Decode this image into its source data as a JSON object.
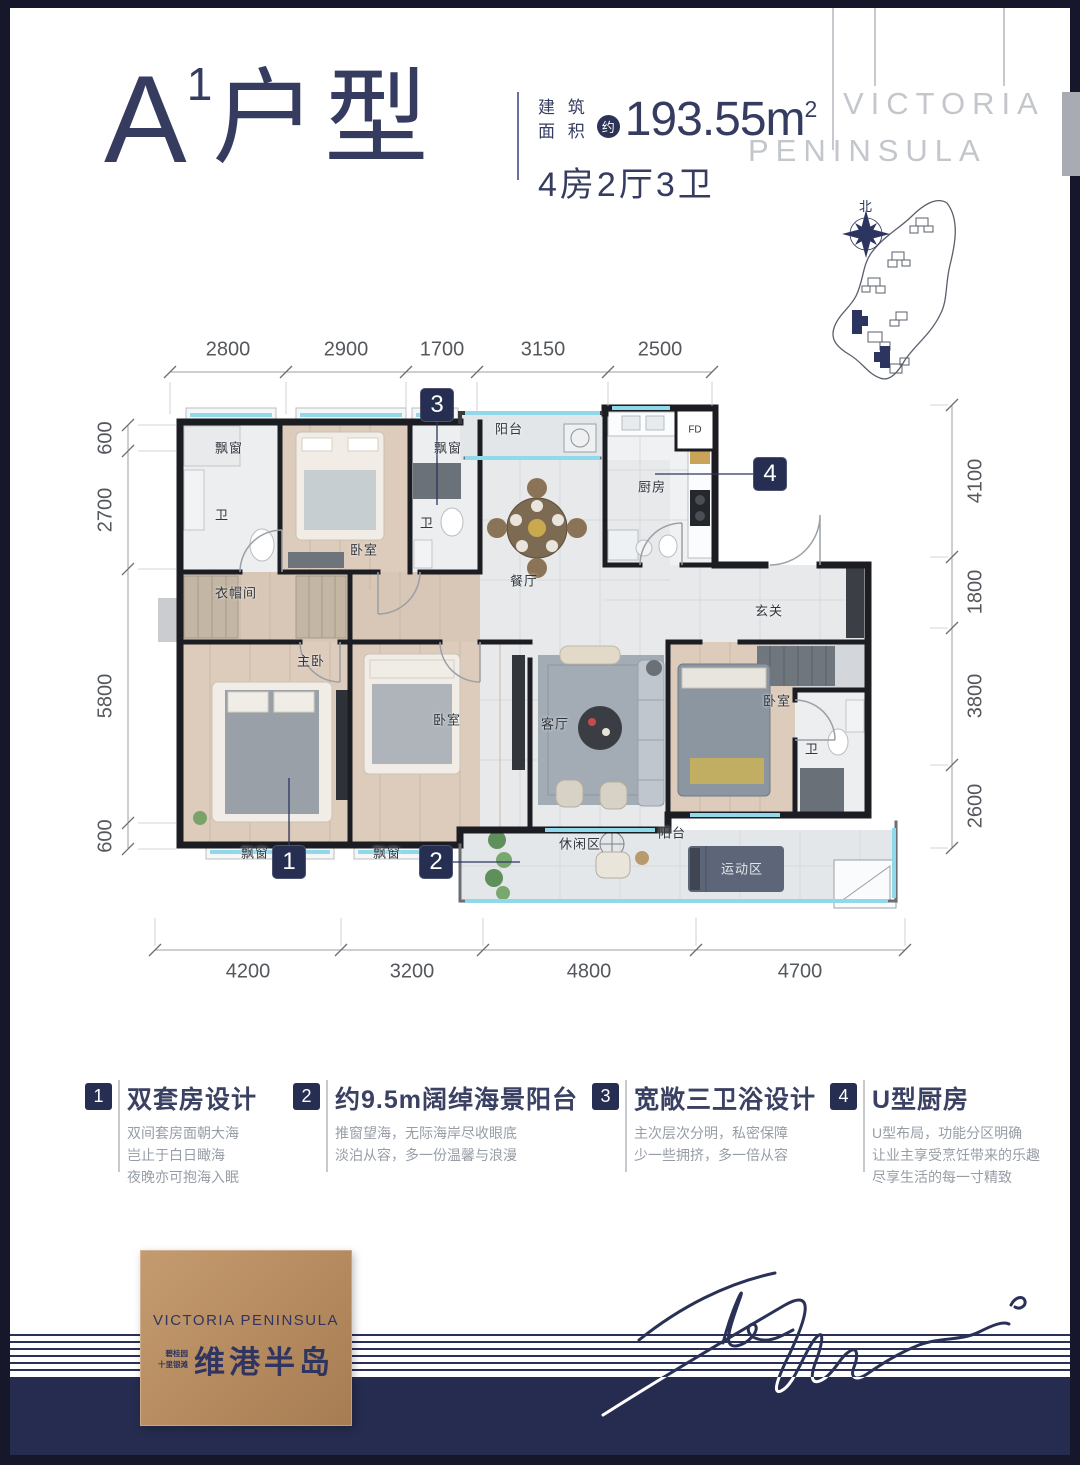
{
  "header": {
    "unit_letter": "A",
    "unit_sup": "1",
    "unit_suffix": "户型",
    "area_label_1": "建 筑",
    "area_label_2": "面 积",
    "approx": "约",
    "area_value": "193.55m",
    "area_sup": "2",
    "rooms": "4房2厅3卫",
    "watermark_1": "VICTORIA",
    "watermark_2": "PENINSULA"
  },
  "sitemap": {
    "north_label": "北"
  },
  "floorplan": {
    "dims_top": [
      "2800",
      "2900",
      "1700",
      "3150",
      "2500"
    ],
    "dims_bottom": [
      "4200",
      "3200",
      "4800",
      "4700"
    ],
    "dims_left": [
      "600",
      "2700",
      "5800",
      "600"
    ],
    "dims_right": [
      "4100",
      "1800",
      "3800",
      "2600"
    ],
    "rooms": [
      "飘窗",
      "卫",
      "卧室",
      "飘窗",
      "卫",
      "衣帽间",
      "阳台",
      "厨房",
      "FD",
      "餐厅",
      "玄关",
      "主卧",
      "卧室",
      "客厅",
      "卧室",
      "卫",
      "飘窗",
      "飘窗",
      "休闲区",
      "阳台",
      "运动区"
    ],
    "markers": [
      "1",
      "2",
      "3",
      "4"
    ]
  },
  "features": [
    {
      "num": "1",
      "title": "双套房设计",
      "lines": [
        "双间套房面朝大海",
        "岂止于白日瞰海",
        "夜晚亦可抱海入眠"
      ]
    },
    {
      "num": "2",
      "title": "约9.5m阔绰海景阳台",
      "lines": [
        "推窗望海，无际海岸尽收眼底",
        "淡泊从容，多一份温馨与浪漫"
      ]
    },
    {
      "num": "3",
      "title": "宽敞三卫浴设计",
      "lines": [
        "主次层次分明，私密保障",
        "少一些拥挤，多一倍从容"
      ]
    },
    {
      "num": "4",
      "title": "U型厨房",
      "lines": [
        "U型布局，功能分区明确",
        "让业主享受烹饪带来的乐趣",
        "尽享生活的每一寸精致"
      ]
    }
  ],
  "footer": {
    "logo_en": "VICTORIA  PENINSULA",
    "logo_small_1": "碧桂园",
    "logo_small_2": "十里银滩",
    "logo_cn": "维港半岛"
  },
  "colors": {
    "navy": "#2c3356",
    "band_navy": "#262c4f",
    "bronze": "#b58a5f",
    "glass_cyan": "#90d9eb",
    "watermark_gray": "#c3c7cc"
  }
}
